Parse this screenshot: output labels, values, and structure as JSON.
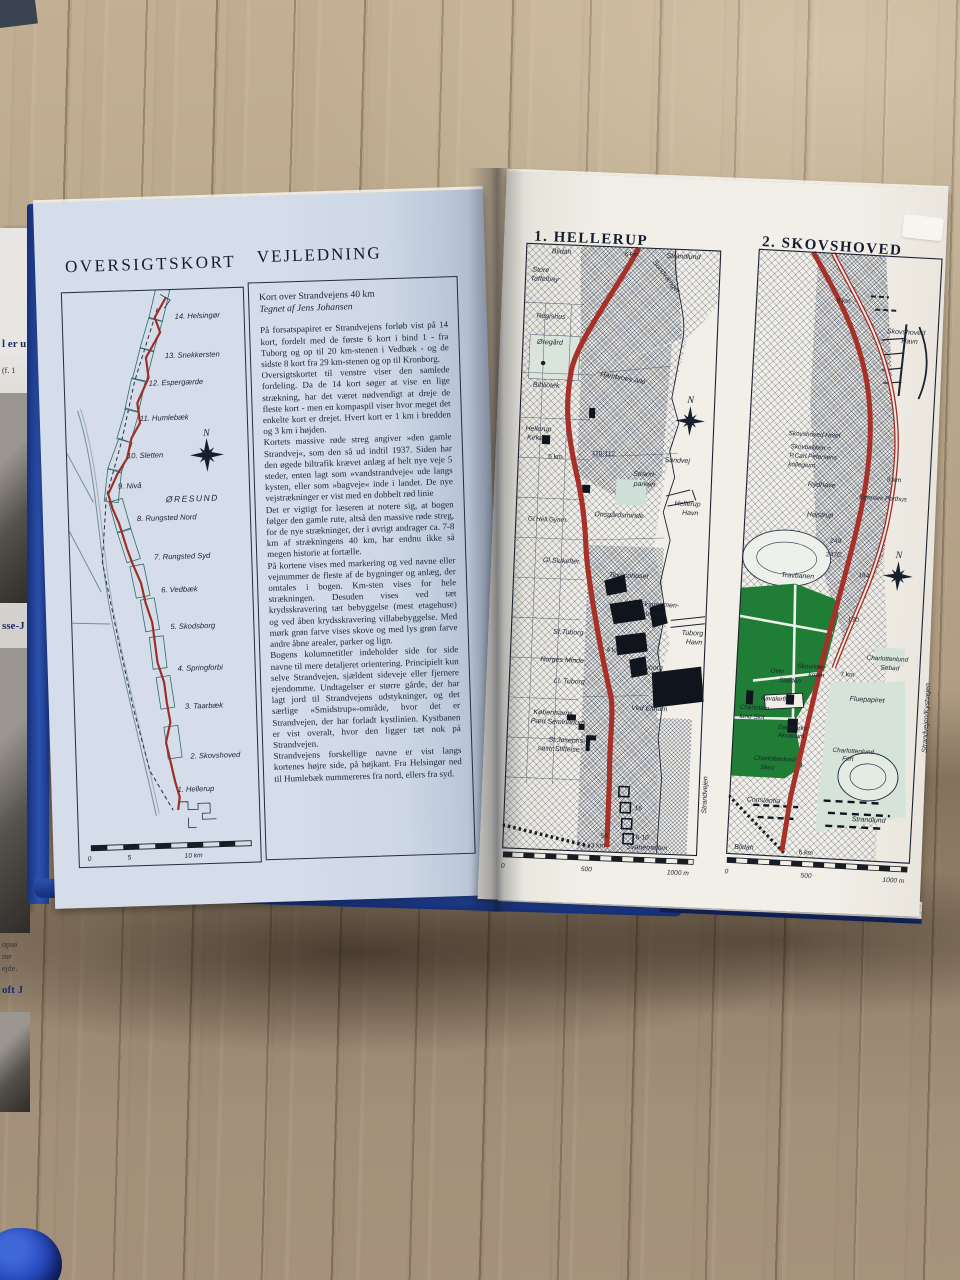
{
  "flap": {
    "fragments": [
      "l er u",
      "(f. 1",
      "sse-J",
      "opsø",
      "me",
      "ejde.",
      "oft J"
    ]
  },
  "left_page": {
    "map_title": "OVERSIGTSKORT",
    "guide_title": "VEJLEDNING",
    "overview": {
      "stations": [
        "14. Helsingør",
        "13. Snekkersten",
        "12. Espergærde",
        "11. Humlebæk",
        "10. Sletten",
        "9. Nivå",
        "8. Rungsted Nord",
        "7. Rungsted Syd",
        "6. Vedbæk",
        "5. Skodsborg",
        "4. Springforbi",
        "3. Taarbæk",
        "2. Skovshoved",
        "1. Hellerup"
      ],
      "sea": "ØRESUND",
      "compass_n": "N",
      "scale_ticks": [
        "0",
        "5",
        "10 km"
      ]
    },
    "guide": {
      "heading": "Kort over Strandvejens 40 km",
      "byline": "Tegnet af Jens Johansen",
      "paragraphs": [
        "På forsatspapiret er Strandvejens forløb vist på 14 kort, fordelt med de første 6 kort i bind 1 - fra Tuborg og op til 20 km-stenen i Vedbæk - og de sidste 8 kort fra 29 km-stenen og op til Kronborg.",
        "Oversigtskortet til venstre viser den samlede fordeling. Da de 14 kort søger at vise en lige strækning, har det været nødvendigt at dreje de fleste kort - men en kompaspil viser hvor meget det enkelte kort er drejet. Hvert kort er 1 km i bredden og 3 km i højden.",
        "Kortets massive røde streg angiver »den gamle Strandvej«, som den så ud indtil 1937. Siden har den øgede biltrafik krævet anlæg af helt nye veje 5 steder, enten lagt som »vandstrandveje« ude langs kysten, eller som »bagveje« inde i landet. De nye vejstrækninger er vist med en dobbelt rød linie",
        "Det er vigtigt for læseren at notere sig, at bogen følger den gamle rute, altså den massive røde streg, for de nye strækninger, der i øvrigt andrager ca. 7-8 km af strækningens 40 km, har endnu ikke så megen historie at fortælle.",
        "På kortene vises med markering og ved navne eller vejnummer de fleste af de bygninger og anlæg, der omtales i bogen. Km-sten vises for hele strækningen. Desuden vises ved tæt krydsskravering tæt bebyggelse (mest etagehuse) og ved åben krydsskravering villabebyggelse. Med mørk grøn farve vises skove og med lys grøn farve andre åbne arealer, parker og lign.",
        "Bogens kolumnetitler indeholder side for side navne til mere detaljeret orientering. Principielt kun selve Strandvejen, sjældent sideveje eller fjernere ejendomme. Undtagelser er større gårde, der har lagt jord til Strandvejens udstykninger, og det særlige »Smidstrup«-område, hvor det er Strandvejen, der har forladt kystlinien. Kystbanen er vist overalt, hvor den ligger tæt nok på Strandvejen.",
        "Strandvejens forskellige navne er vist langs kortenes højre side, på højkant. Fra Helsingør ned til Humlebæk nummereres fra nord, ellers fra syd."
      ]
    }
  },
  "right_page": {
    "hellerup": {
      "title": "1. HELLERUP",
      "compass_n": "N",
      "side_road": "Strandvejen",
      "scale_ticks": [
        "0",
        "500",
        "1000 m"
      ],
      "labels": [
        "Blidah",
        "6 km",
        "Strandlund",
        "Sundvænget",
        "Store",
        "Taffelbay",
        "Regishus",
        "Øregård",
        "Hambroes Allé",
        "Bibliotek",
        "Hellerup",
        "Kirke",
        "5 km",
        "110-112",
        "Sundvej",
        "Strand-",
        "parken",
        "Hellerup",
        "Havn",
        "Onsgårdsminde",
        "Gl.Hell.Gymn.",
        "Gl.Slukefter",
        "Texacohuset",
        "Eksperimen-",
        "tarium",
        "St.Tuborg",
        "4 km",
        "Tuborg",
        "Havn",
        "Norges Minde",
        "Tuborg",
        "Ll. Tuborg",
        "Ved Eltham",
        "Københavns",
        "Pæd Seminarium",
        "St.Josephs-",
        "søstr.Stiftelse",
        "16",
        "59",
        "8-10",
        "3 km",
        "Svanemøllen"
      ]
    },
    "skovshoved": {
      "title": "2. SKOVSHOVED",
      "compass_n": "N",
      "side_road": "Strandvejen/Kystvejen",
      "scale_ticks": [
        "0",
        "500",
        "1000 m"
      ],
      "labels": [
        "9 km",
        "Skovshoved",
        "Havn",
        "Skovshoved Hotel",
        "Skovbakken =",
        "P.Carl Petersens",
        "kollegium",
        "8 km",
        "Rydhave",
        "Egenæs Porthus",
        "Højstrup",
        "249",
        "247C",
        "Travbanen",
        "184",
        "170",
        "Charlottenlund",
        "Søbad",
        "7 km",
        "Skovrider-",
        "kroen",
        "Over",
        "Stalden",
        "Kavalerfløj",
        "Charlotten-",
        "lund Slot",
        "Fluepapiret",
        "Danmarks",
        "Akvarium",
        "Charlottenlund",
        "Fort",
        "Charlottenlund",
        "Skov",
        "Constantia",
        "Strandlund",
        "Blidah",
        "6 km"
      ]
    }
  }
}
